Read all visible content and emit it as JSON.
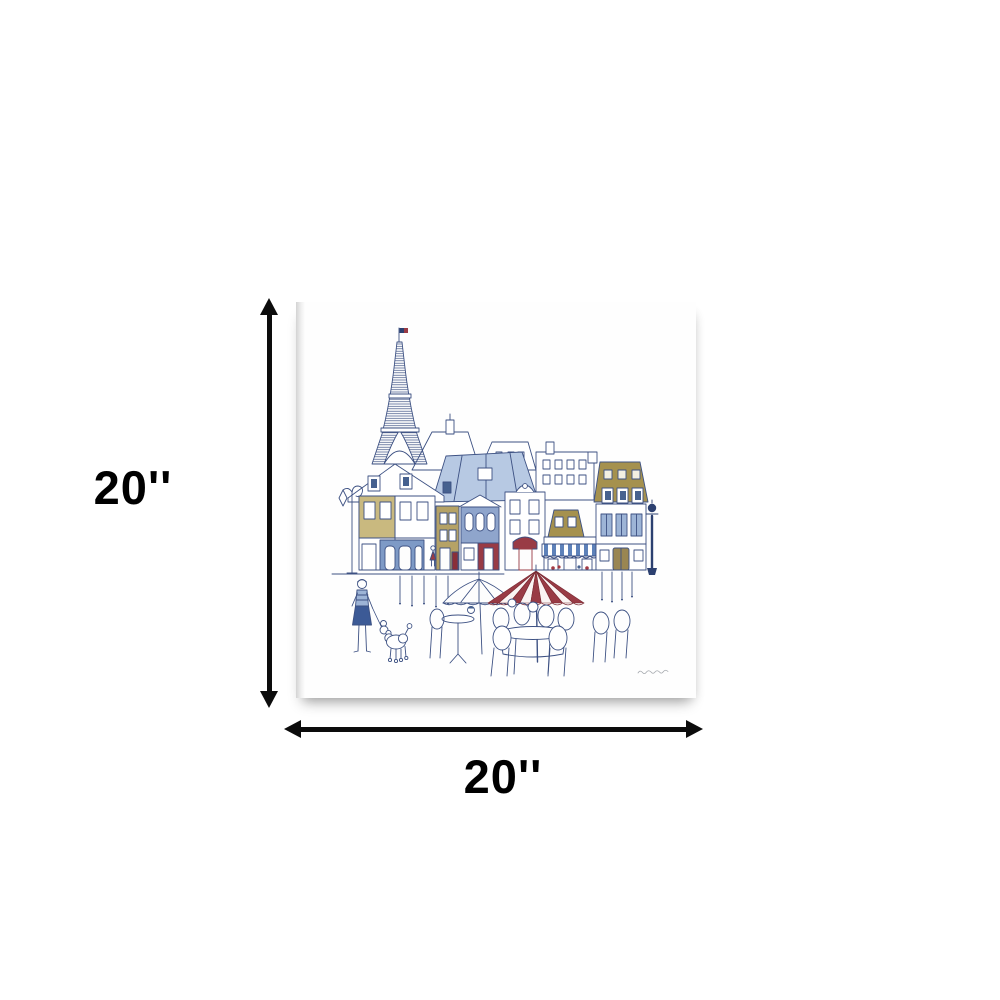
{
  "page": {
    "background": "#ffffff"
  },
  "dimensions": {
    "height_label": "20''",
    "width_label": "20''",
    "arrow_color": "#0c0c0c",
    "label_color": "#000000"
  },
  "canvas_print": {
    "description": "Square gallery-wrapped white canvas wall-art print",
    "artwork_scene": "Whimsical ink-and-watercolor Paris street scene: Eiffel Tower with French flag, Parisian shop buildings, street lamps, sidewalk cafe with red striped umbrella, tables and chairs, woman walking a poodle",
    "signature": "small illegible cursive artist signature, lower right",
    "palette": {
      "ink_blue": "#3d5183",
      "navy": "#2c4070",
      "slate_blue": "#7e9ac6",
      "light_blue": "#b7c9e3",
      "gold": "#a5914e",
      "red": "#993b45"
    }
  }
}
